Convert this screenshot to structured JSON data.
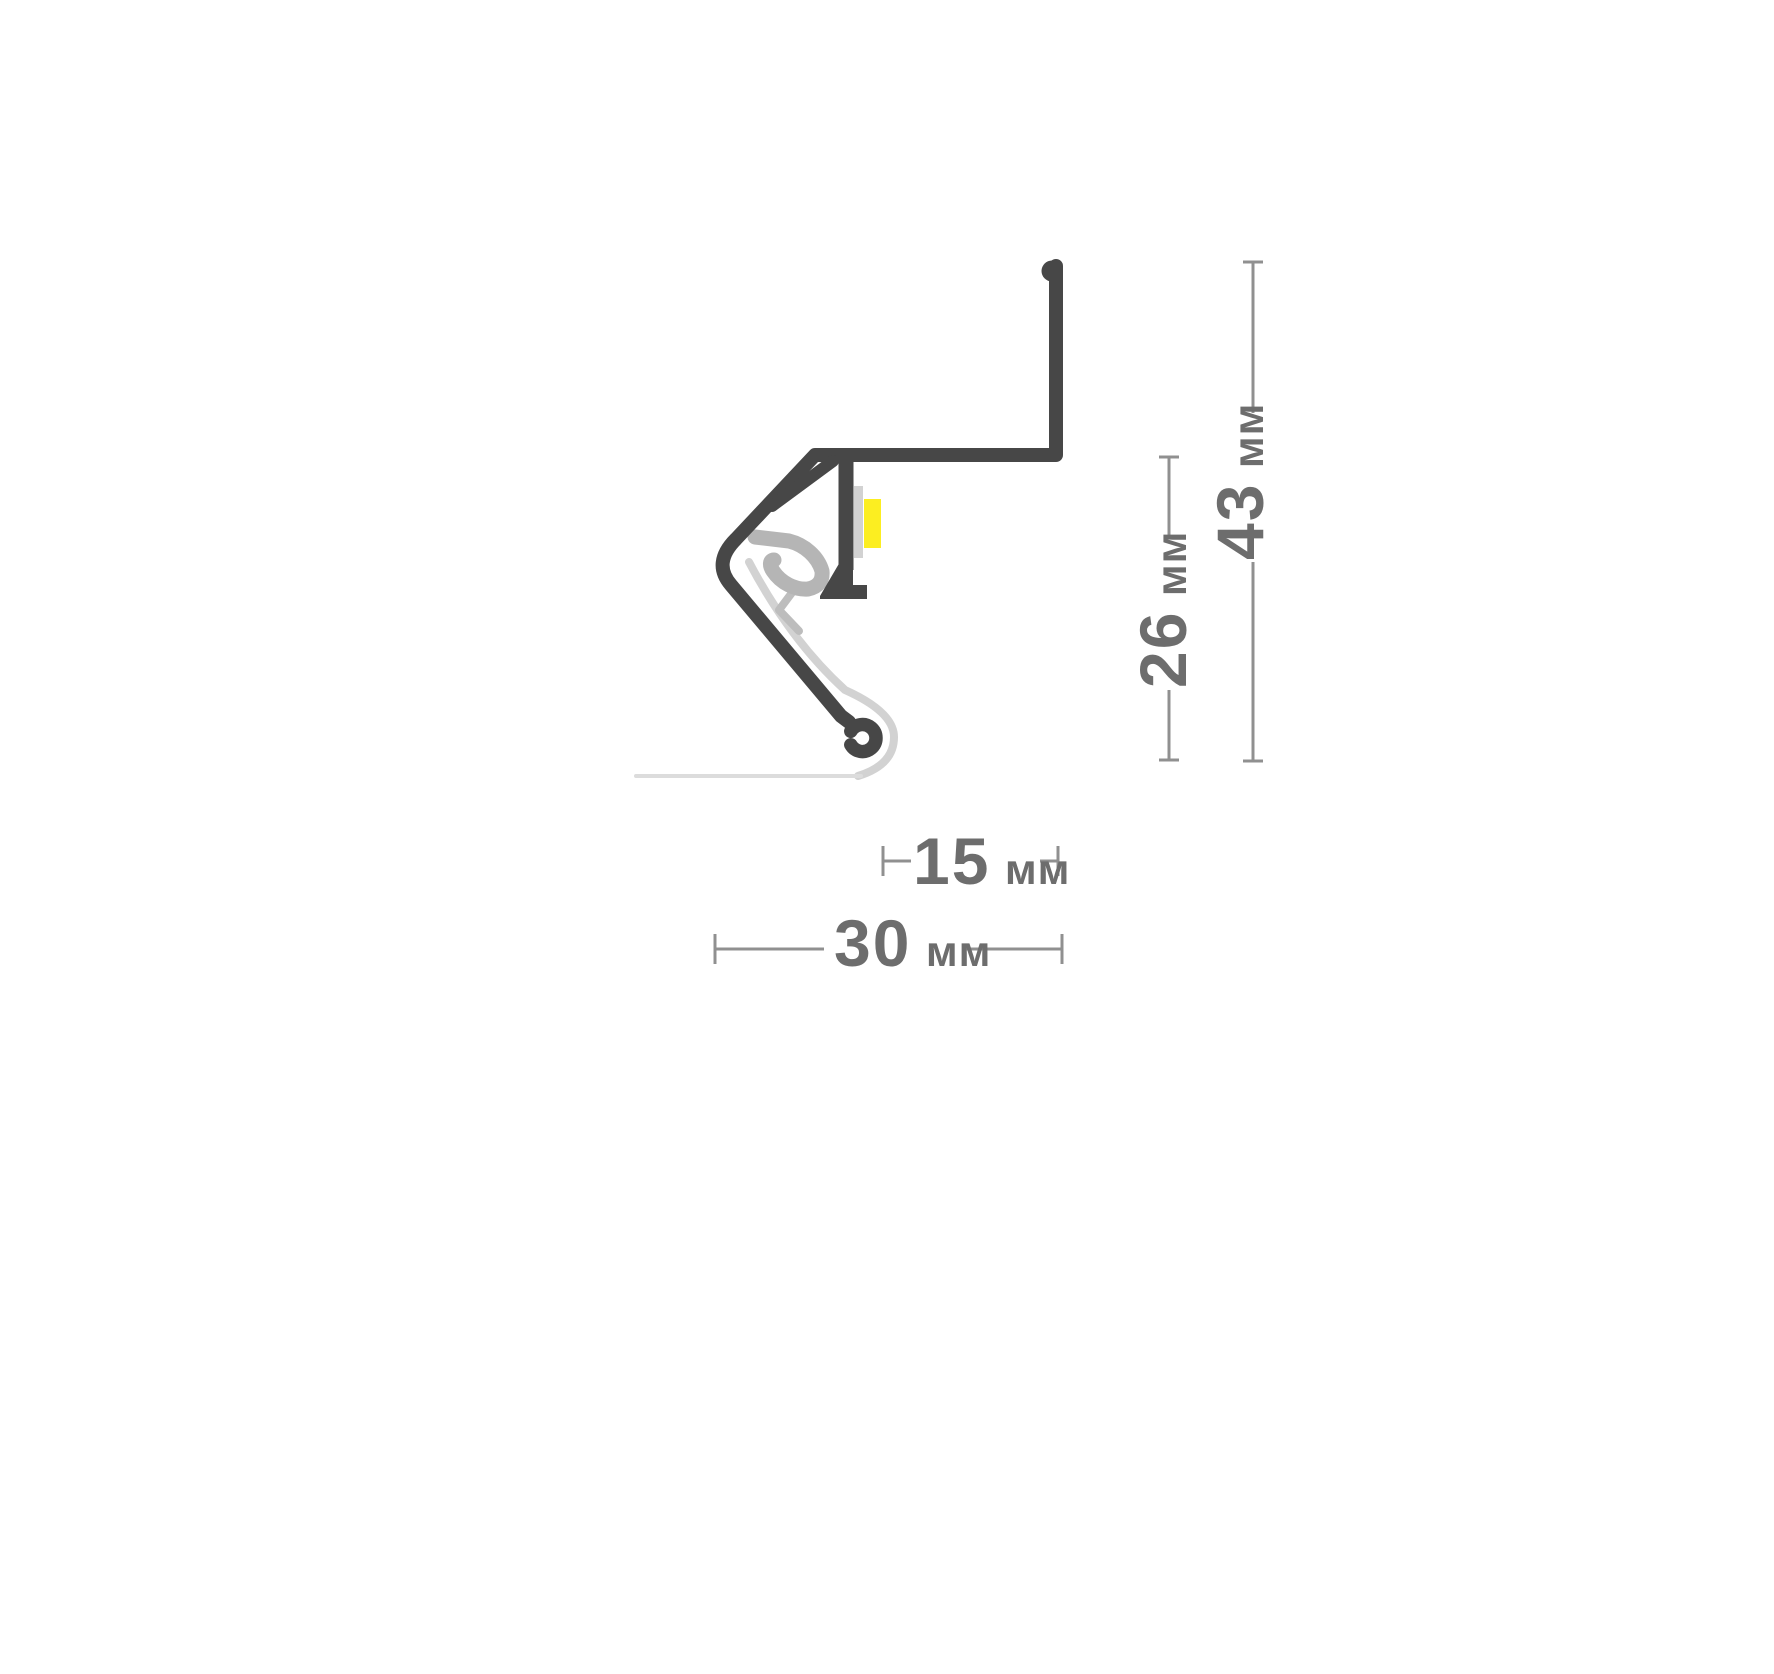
{
  "figure": {
    "kind": "led-profile-cross-section",
    "background": "#ffffff",
    "colors": {
      "profile": "#474747",
      "clip": "#b5b5b5",
      "clip_tail": "#bdbdbd",
      "diffuser": "#d2d2d2",
      "surface_line": "#dcdcdc",
      "pcb": "#d2d2d2",
      "led": "#fcee21",
      "dim_line": "#909090",
      "dim_text": "#6d6d6d"
    },
    "dimensions": {
      "inner_width": {
        "value": "15",
        "unit": "мм"
      },
      "overall_width": {
        "value": "30",
        "unit": "мм"
      },
      "inner_height": {
        "value": "26",
        "unit": "мм"
      },
      "overall_height": {
        "value": "43",
        "unit": "мм"
      }
    }
  }
}
